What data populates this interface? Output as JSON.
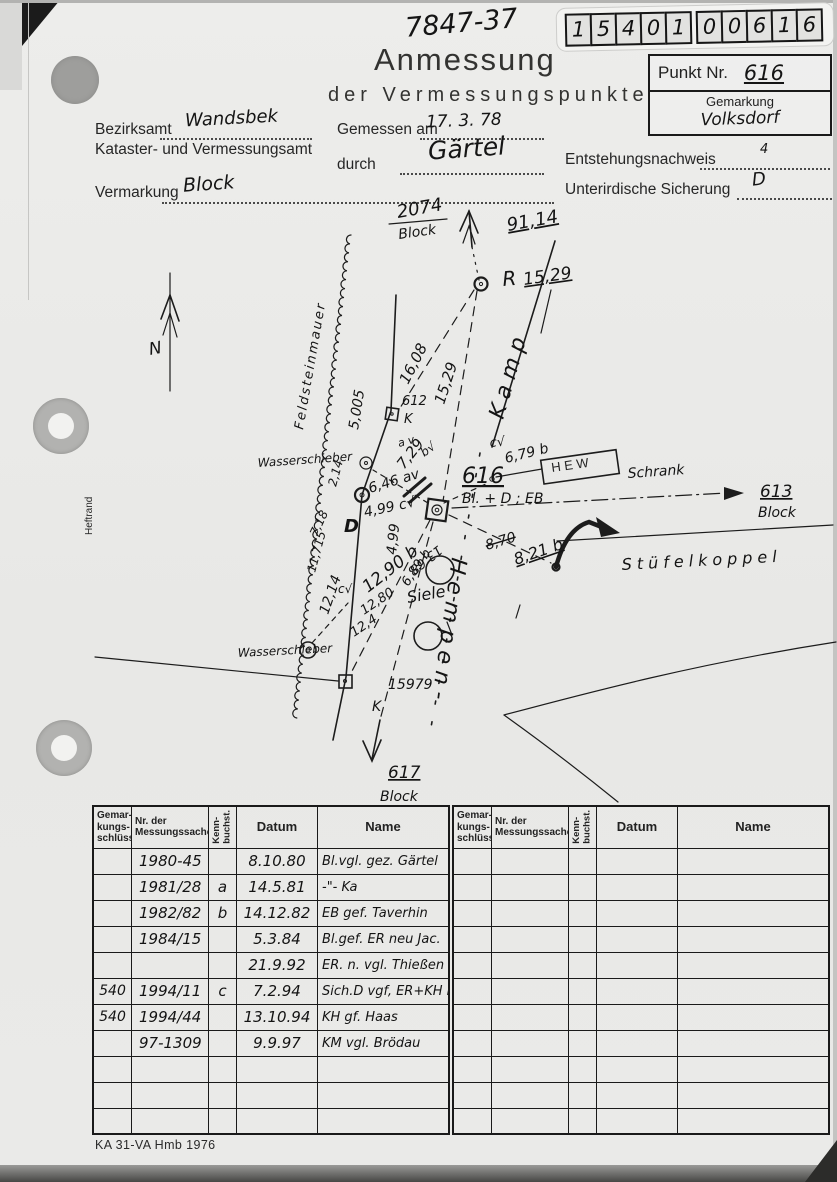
{
  "page": {
    "code_top": "7847-37",
    "digits": [
      "1",
      "5",
      "4",
      "0",
      "1",
      "0",
      "0",
      "6",
      "1",
      "6"
    ],
    "title": "Anmessung",
    "subtitle": "der Vermessungspunkte",
    "footer": "KA 31-VA Hmb 1976"
  },
  "punkt": {
    "punkt_label": "Punkt Nr.",
    "punkt_value": "616",
    "gemarkung_label": "Gemarkung",
    "gemarkung_value": "Volksdorf"
  },
  "form": {
    "bezirksamt_label": "Bezirksamt",
    "bezirksamt_value": "Wandsbek",
    "amt_label": "Kataster- und Vermessungsamt",
    "gemessen_label": "Gemessen am",
    "gemessen_value": "17. 3. 78",
    "durch_label": "durch",
    "durch_value": "Gärtel",
    "entstehung_label": "Entstehungsnachweis",
    "entstehung_value": "4",
    "sicherung_label": "Unterirdische Sicherung",
    "sicherung_value": "D",
    "vermarkung_label": "Vermarkung",
    "vermarkung_value": "Block"
  },
  "sketch": {
    "labels": [
      {
        "t": "2074",
        "x": 398,
        "y": 23,
        "r": -10,
        "s": 18
      },
      {
        "t": "Block",
        "x": 399,
        "y": 44,
        "r": -8,
        "s": 14
      },
      {
        "t": "91,14",
        "x": 508,
        "y": 36,
        "r": -10,
        "s": 18,
        "c": "u"
      },
      {
        "t": "R",
        "x": 503,
        "y": 91,
        "r": -5,
        "s": 20
      },
      {
        "t": "15,29",
        "x": 524,
        "y": 90,
        "r": -8,
        "s": 17,
        "c": "u"
      },
      {
        "t": "16,08",
        "x": 408,
        "y": 190,
        "r": -63,
        "s": 15
      },
      {
        "t": "15,29",
        "x": 444,
        "y": 210,
        "r": -72,
        "s": 15
      },
      {
        "t": "612",
        "x": 402,
        "y": 210,
        "s": 13
      },
      {
        "t": "K",
        "x": 404,
        "y": 228,
        "s": 13
      },
      {
        "t": "5,005",
        "x": 358,
        "y": 235,
        "r": -81,
        "s": 14
      },
      {
        "t": "Wasserschieber",
        "x": 258,
        "y": 272,
        "r": -4,
        "s": 12
      },
      {
        "t": "2,14",
        "x": 336,
        "y": 292,
        "r": -75,
        "s": 12
      },
      {
        "t": "7,18",
        "x": 317,
        "y": 342,
        "r": -65,
        "s": 12
      },
      {
        "t": "D",
        "x": 344,
        "y": 337,
        "s": 18,
        "c": "b"
      },
      {
        "t": "a v",
        "x": 399,
        "y": 252,
        "r": -15,
        "s": 11
      },
      {
        "t": "7,29",
        "x": 404,
        "y": 275,
        "r": -52,
        "s": 15
      },
      {
        "t": "b√",
        "x": 424,
        "y": 262,
        "r": -35,
        "s": 12
      },
      {
        "t": "6,46 av",
        "x": 370,
        "y": 298,
        "r": -17,
        "s": 14
      },
      {
        "t": "4,99 c√",
        "x": 365,
        "y": 322,
        "r": -12,
        "s": 14
      },
      {
        "t": "4,99",
        "x": 396,
        "y": 360,
        "r": -84,
        "s": 14
      },
      {
        "t": "616",
        "x": 462,
        "y": 288,
        "s": 22,
        "c": "u"
      },
      {
        "t": "Bl. + D ; EB",
        "x": 462,
        "y": 308,
        "s": 14
      },
      {
        "t": "6,79 b",
        "x": 506,
        "y": 268,
        "r": -14,
        "s": 14
      },
      {
        "t": "c√",
        "x": 490,
        "y": 252,
        "r": -5,
        "s": 13
      },
      {
        "t": "H E W",
        "x": 552,
        "y": 277,
        "r": -8,
        "s": 13,
        "c": "print"
      },
      {
        "t": "Schrank",
        "x": 628,
        "y": 283,
        "r": -4,
        "s": 14
      },
      {
        "t": "Kamp",
        "x": 503,
        "y": 225,
        "r": -74,
        "s": 22,
        "c": "sp"
      },
      {
        "t": "Hempen-",
        "x": 452,
        "y": 362,
        "r": 98,
        "s": 22,
        "c": "sp"
      },
      {
        "t": "Stüfelkoppel",
        "x": 622,
        "y": 375,
        "r": -3,
        "s": 16,
        "c": "sp2"
      },
      {
        "t": "613",
        "x": 760,
        "y": 302,
        "s": 17,
        "c": "u"
      },
      {
        "t": "Block",
        "x": 758,
        "y": 322,
        "s": 14
      },
      {
        "t": "617",
        "x": 388,
        "y": 583,
        "s": 17,
        "c": "u"
      },
      {
        "t": "Block",
        "x": 380,
        "y": 606,
        "s": 14
      },
      {
        "t": "15979",
        "x": 388,
        "y": 494,
        "s": 14
      },
      {
        "t": "K",
        "x": 372,
        "y": 516,
        "s": 14
      },
      {
        "t": "Wasserschieber",
        "x": 238,
        "y": 462,
        "r": -3,
        "s": 12
      },
      {
        "t": "12,14",
        "x": 328,
        "y": 420,
        "r": -71,
        "s": 14
      },
      {
        "t": "11,715",
        "x": 315,
        "y": 378,
        "r": -75,
        "s": 12
      },
      {
        "t": "12,90 b",
        "x": 368,
        "y": 398,
        "r": -38,
        "s": 17
      },
      {
        "t": "12,80",
        "x": 364,
        "y": 420,
        "r": -34,
        "s": 13
      },
      {
        "t": "12,4",
        "x": 354,
        "y": 442,
        "r": -34,
        "s": 13
      },
      {
        "t": "13,68",
        "x": 438,
        "y": 350,
        "r": 142,
        "s": 13
      },
      {
        "t": "6,89 b",
        "x": 408,
        "y": 392,
        "r": -56,
        "s": 13
      },
      {
        "t": "8,70",
        "x": 487,
        "y": 355,
        "r": -17,
        "s": 14,
        "c": "st"
      },
      {
        "t": "8,21 b",
        "x": 516,
        "y": 370,
        "r": -19,
        "s": 16,
        "c": "u"
      },
      {
        "t": "Siele",
        "x": 408,
        "y": 408,
        "r": -10,
        "s": 16
      },
      {
        "t": "c√",
        "x": 338,
        "y": 398,
        "s": 12
      },
      {
        "t": "N",
        "x": 150,
        "y": 160,
        "r": -10,
        "s": 17
      },
      {
        "t": "Feldsteinmauer",
        "x": 303,
        "y": 235,
        "r": -80,
        "s": 13,
        "c": "sp3"
      },
      {
        "t": "Heftrand",
        "x": 92,
        "y": 340,
        "r": -90,
        "s": 10,
        "c": "print"
      }
    ]
  },
  "table": {
    "headers": [
      {
        "text": "Gemar-\nkungs-\nschlüssel",
        "vert": false
      },
      {
        "text": "Nr. der\nMessungssache",
        "vert": false
      },
      {
        "text": "Kenn-\nbuchst.",
        "vert": true
      },
      {
        "text": "Datum",
        "vert": false
      },
      {
        "text": "Name",
        "vert": false
      }
    ],
    "left_rows": [
      [
        "",
        "1980-45",
        "",
        "8.10.80",
        "Bl.vgl. gez. Gärtel"
      ],
      [
        "",
        "1981/28",
        "a",
        "14.5.81",
        "-\"-   Ka"
      ],
      [
        "",
        "1982/82",
        "b",
        "14.12.82",
        "EB gef. Taverhin"
      ],
      [
        "",
        "1984/15",
        "",
        "5.3.84",
        "Bl.gef. ER neu Jac."
      ],
      [
        "",
        "",
        "",
        "21.9.92",
        "ER. n. vgl. Thießen"
      ],
      [
        "540",
        "1994/11",
        "c",
        "7.2.94",
        "Sich.D vgf, ER+KH neu Haas"
      ],
      [
        "540",
        "1994/44",
        "",
        "13.10.94",
        "KH gf.  Haas"
      ],
      [
        "",
        "97-1309",
        "",
        "9.9.97",
        "KM vgl. Brödau"
      ],
      [
        "",
        "",
        "",
        "",
        ""
      ],
      [
        "",
        "",
        "",
        "",
        ""
      ],
      [
        "",
        "",
        "",
        "",
        ""
      ]
    ],
    "right_rows": [
      [
        "",
        "",
        "",
        "",
        ""
      ],
      [
        "",
        "",
        "",
        "",
        ""
      ],
      [
        "",
        "",
        "",
        "",
        ""
      ],
      [
        "",
        "",
        "",
        "",
        ""
      ],
      [
        "",
        "",
        "",
        "",
        ""
      ],
      [
        "",
        "",
        "",
        "",
        ""
      ],
      [
        "",
        "",
        "",
        "",
        ""
      ],
      [
        "",
        "",
        "",
        "",
        ""
      ],
      [
        "",
        "",
        "",
        "",
        ""
      ],
      [
        "",
        "",
        "",
        "",
        ""
      ],
      [
        "",
        "",
        "",
        "",
        ""
      ]
    ]
  }
}
